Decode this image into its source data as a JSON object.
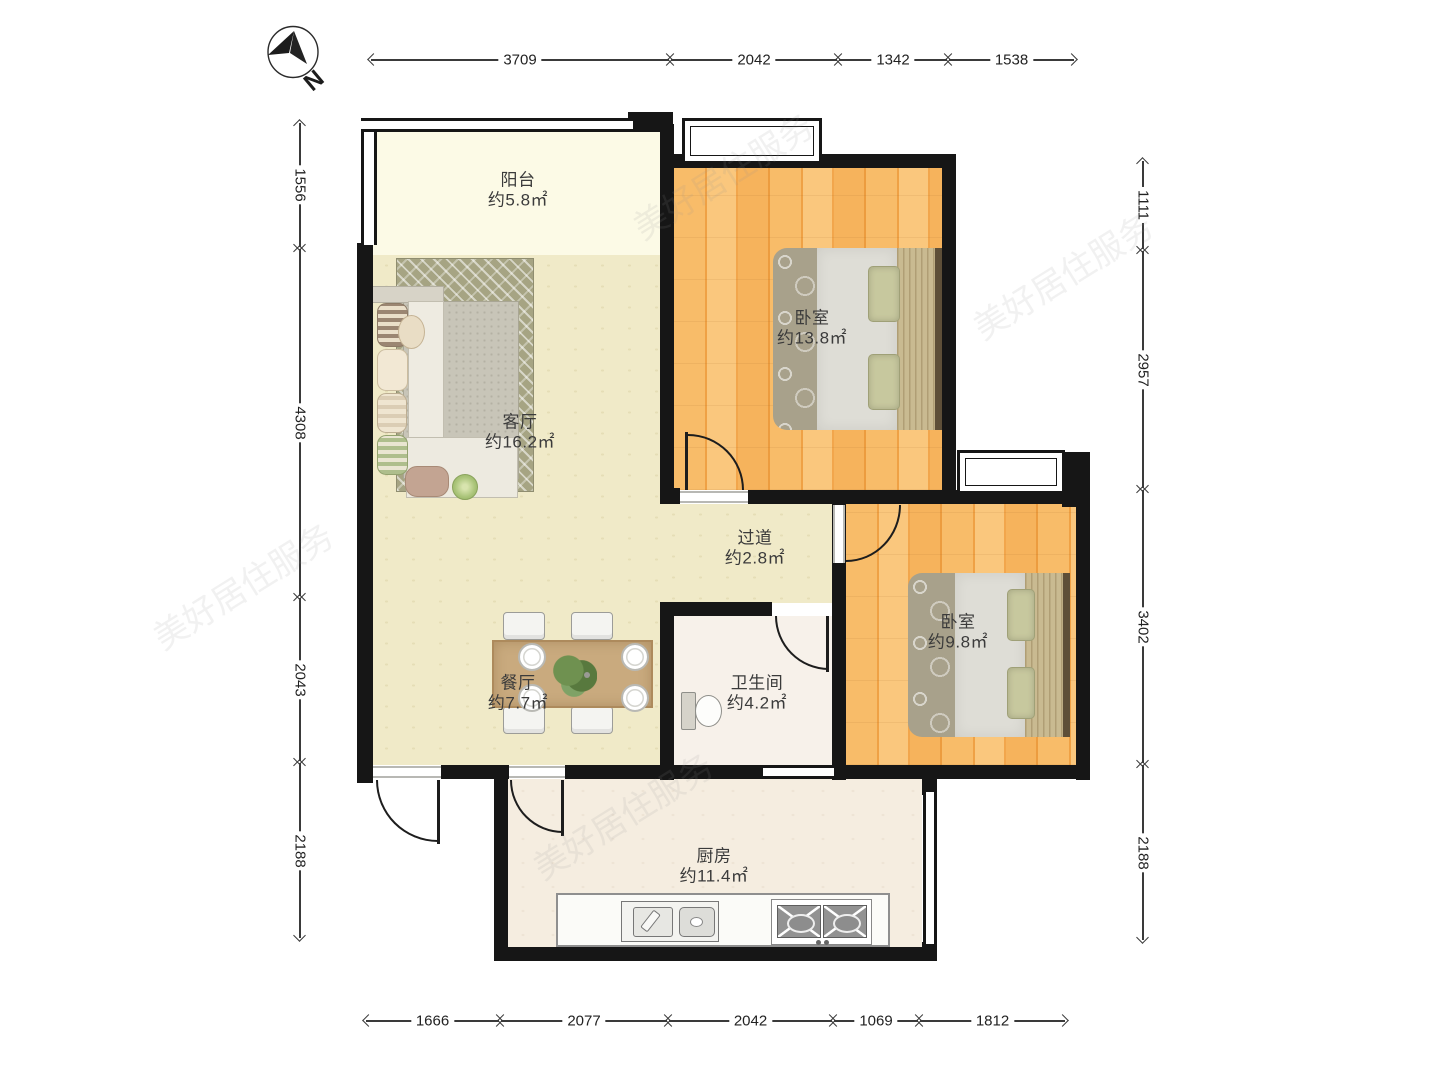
{
  "compass": {
    "label": "N"
  },
  "watermark": {
    "text": "美好居住服务"
  },
  "rooms": [
    {
      "id": "balcony",
      "name": "阳台",
      "area": "约5.8㎡"
    },
    {
      "id": "living",
      "name": "客厅",
      "area": "约16.2㎡"
    },
    {
      "id": "bedroom1",
      "name": "卧室",
      "area": "约13.8㎡"
    },
    {
      "id": "hallway",
      "name": "过道",
      "area": "约2.8㎡"
    },
    {
      "id": "bedroom2",
      "name": "卧室",
      "area": "约9.8㎡"
    },
    {
      "id": "dining",
      "name": "餐厅",
      "area": "约7.7㎡"
    },
    {
      "id": "bathroom",
      "name": "卫生间",
      "area": "约4.2㎡"
    },
    {
      "id": "kitchen",
      "name": "厨房",
      "area": "约11.4㎡"
    }
  ],
  "dimensions": {
    "top": {
      "y": 60,
      "segments": [
        {
          "label": "3709",
          "from": 370,
          "to": 670
        },
        {
          "label": "2042",
          "from": 670,
          "to": 838
        },
        {
          "label": "1342",
          "from": 838,
          "to": 948
        },
        {
          "label": "1538",
          "from": 948,
          "to": 1075
        }
      ]
    },
    "bottom": {
      "y": 1021,
      "segments": [
        {
          "label": "1666",
          "from": 365,
          "to": 500
        },
        {
          "label": "2077",
          "from": 500,
          "to": 668
        },
        {
          "label": "2042",
          "from": 668,
          "to": 833
        },
        {
          "label": "1069",
          "from": 833,
          "to": 919
        },
        {
          "label": "1812",
          "from": 919,
          "to": 1066
        }
      ]
    },
    "left": {
      "x": 300,
      "segments": [
        {
          "label": "1556",
          "from": 122,
          "to": 248
        },
        {
          "label": "4308",
          "from": 248,
          "to": 597
        },
        {
          "label": "2043",
          "from": 597,
          "to": 762
        },
        {
          "label": "2188",
          "from": 762,
          "to": 939
        }
      ]
    },
    "right": {
      "x": 1143,
      "segments": [
        {
          "label": "1111",
          "from": 160,
          "to": 250
        },
        {
          "label": "2957",
          "from": 250,
          "to": 489
        },
        {
          "label": "3402",
          "from": 489,
          "to": 764
        },
        {
          "label": "2188",
          "from": 764,
          "to": 941
        }
      ]
    }
  }
}
